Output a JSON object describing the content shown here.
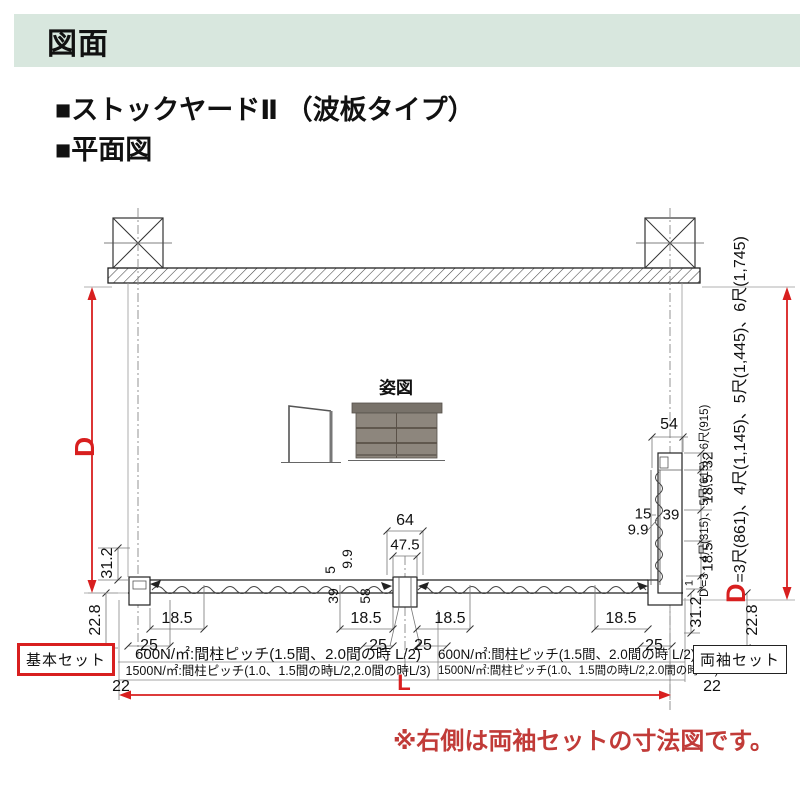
{
  "header": {
    "title": "図面",
    "bg": "#d8e7de"
  },
  "titles": {
    "line1": "■ストックヤードⅡ （波板タイプ）",
    "line2": "■平面図"
  },
  "elevation": {
    "label": "姿図"
  },
  "axis": {
    "d_label": "D",
    "l_label": "L",
    "d_formula_prefix": "D",
    "d_formula": "=3尺(861)、4尺(1,145)、5尺(1,445)、6尺(1,745)",
    "dprime_formula": "D'=3・4尺(315)、5尺(615)、6尺(915)"
  },
  "specs": {
    "left": {
      "row1": "600N/㎡:間柱ピッチ(1.5間、2.0間の時 L/2)",
      "row2": "1500N/㎡:間柱ピッチ(1.0、1.5間の時L/2,2.0間の時L/3)"
    },
    "right": {
      "row1": "600N/㎡:間柱ピッチ(1.5間、2.0間の時 L/2)",
      "row2": "1500N/㎡:間柱ピッチ(1.0、1.5間の時L/2,2.0間の時L/3)"
    }
  },
  "boxes": {
    "basic": "基本セット",
    "ryousode": "両袖セット"
  },
  "note": {
    "text": "※右側は両袖セットの寸法図です。"
  },
  "colors": {
    "accent_red": "#d81f1f",
    "note_red": "#c13b38",
    "header_bg": "#d8e7de",
    "panel_gray": "#8d867d"
  },
  "dim_labels": [
    {
      "text": "54",
      "x": 669,
      "y": 425
    },
    {
      "text": "64",
      "x": 405,
      "y": 521
    },
    {
      "text": "47.5",
      "x": 405,
      "y": 545,
      "size": 15
    },
    {
      "text": "15",
      "x": 643,
      "y": 514,
      "size": 15
    },
    {
      "text": "39",
      "x": 671,
      "y": 515,
      "size": 15
    },
    {
      "text": "9.9",
      "x": 638,
      "y": 530,
      "size": 15
    },
    {
      "text": "18.5",
      "x": 177,
      "y": 619
    },
    {
      "text": "25",
      "x": 149,
      "y": 646
    },
    {
      "text": "18.5",
      "x": 366,
      "y": 619
    },
    {
      "text": "25",
      "x": 378,
      "y": 646
    },
    {
      "text": "18.5",
      "x": 450,
      "y": 619
    },
    {
      "text": "25",
      "x": 423,
      "y": 646
    },
    {
      "text": "18.5",
      "x": 621,
      "y": 619
    },
    {
      "text": "25",
      "x": 654,
      "y": 646
    },
    {
      "text": "22",
      "x": 121,
      "y": 687
    },
    {
      "text": "22",
      "x": 712,
      "y": 687
    },
    {
      "text": "31.2",
      "x": 108,
      "y": 563,
      "rot": true
    },
    {
      "text": "22.8",
      "x": 96,
      "y": 620,
      "rot": true
    },
    {
      "text": "5",
      "x": 330,
      "y": 570,
      "rot": true,
      "size": 14
    },
    {
      "text": "9.9",
      "x": 347,
      "y": 559,
      "rot": true,
      "size": 14
    },
    {
      "text": "39",
      "x": 333,
      "y": 596,
      "rot": true,
      "size": 14
    },
    {
      "text": "58",
      "x": 365,
      "y": 596,
      "rot": true,
      "size": 14
    },
    {
      "text": "32",
      "x": 708,
      "y": 460,
      "rot": true,
      "size": 15
    },
    {
      "text": "18.5",
      "x": 708,
      "y": 489,
      "rot": true,
      "size": 15
    },
    {
      "text": "18.5",
      "x": 708,
      "y": 557,
      "rot": true,
      "size": 15
    },
    {
      "text": "1",
      "x": 690,
      "y": 583,
      "rot": true,
      "size": 11
    },
    {
      "text": "31.2",
      "x": 697,
      "y": 612,
      "rot": true
    },
    {
      "text": "22.8",
      "x": 753,
      "y": 620,
      "rot": true
    }
  ]
}
